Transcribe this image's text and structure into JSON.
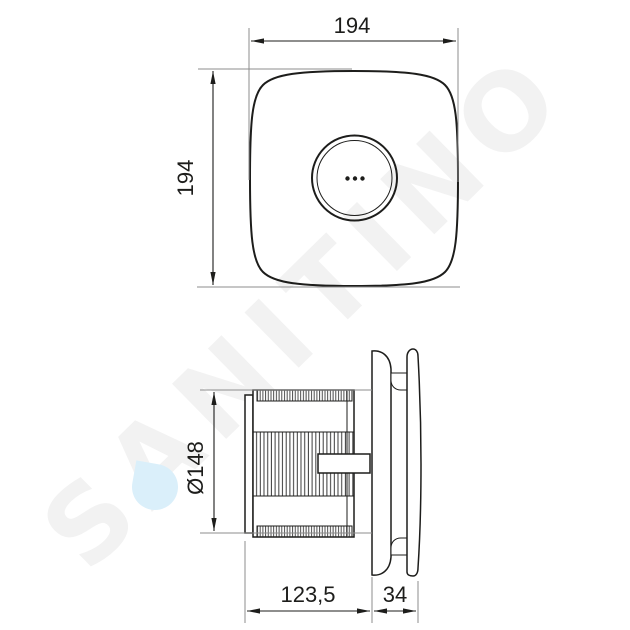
{
  "watermark": {
    "text": "SANITINO",
    "color": "#f2f2f2",
    "drop_color": "#daeffa"
  },
  "colors": {
    "line": "#1d1d1b",
    "ext": "#8c8c8c",
    "watermark": "#f2f2f2",
    "drop": "#daeffa",
    "bg": "#ffffff"
  },
  "drawing": {
    "type": "technical-dimension-drawing",
    "subject": "wall extractor fan, front view and side view",
    "units_shown": "mm (implied, not labeled)"
  },
  "dimensions": {
    "front_width": "194",
    "front_height": "194",
    "duct_diameter": "Ø148",
    "body_depth": "123,5",
    "panel_depth": "34"
  }
}
